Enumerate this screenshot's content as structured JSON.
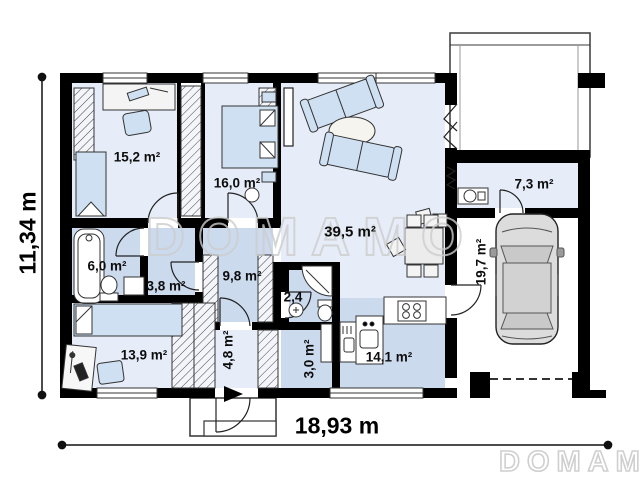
{
  "watermarks": {
    "center": "DOMAMO",
    "corner": "DOMAMO"
  },
  "dimensions": {
    "width": "18,93 m",
    "height": "11,34 m"
  },
  "rooms": {
    "bedroom1": "15,2 m²",
    "bedroom2": "16,0 m²",
    "living": "39,5 m²",
    "utility": "7,3 m²",
    "bathroom": "6,0 m²",
    "hall": "3,8 m²",
    "corridor": "9,8 m²",
    "wc": "2,4",
    "garage": "19,7 m²",
    "bedroom3": "13,9 m²",
    "vestibule": "4,8 m²",
    "pantry": "3,0 m²",
    "kitchen": "14,1 m²"
  },
  "colors": {
    "wall": "#000000",
    "floor_light": "#e7edf8",
    "floor_medium": "#ccdaee",
    "furniture_blue": "#cfe0f2",
    "watermark_gray": "#cdcdcd"
  }
}
